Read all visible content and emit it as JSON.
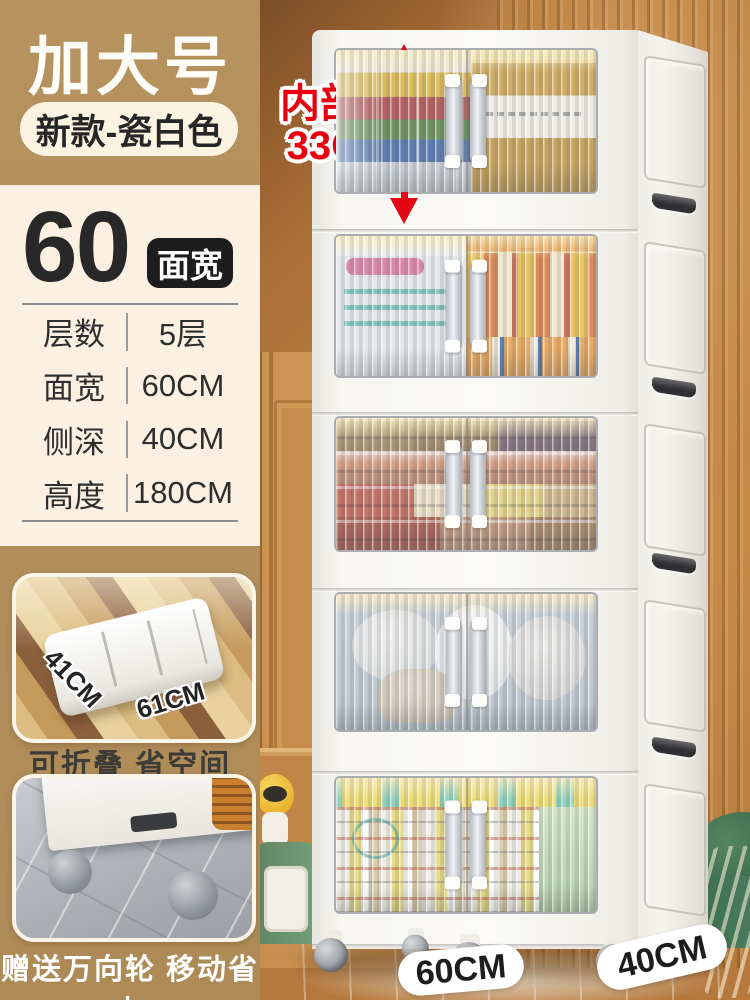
{
  "sidebar": {
    "title": "加大号",
    "variant_pill": "新款-瓷白色",
    "size": {
      "number": "60",
      "badge": "面宽"
    },
    "specs": [
      {
        "label": "层数",
        "value": "5层"
      },
      {
        "label": "面宽",
        "value": "60CM"
      },
      {
        "label": "侧深",
        "value": "40CM"
      },
      {
        "label": "高度",
        "value": "180CM"
      }
    ],
    "fold_photo": {
      "dim_left": "41CM",
      "dim_right": "61CM",
      "caption": "可折叠 省空间"
    },
    "wheel_photo": {
      "caption": "赠送万向轮 移动省力"
    }
  },
  "product": {
    "tier_count": 5,
    "annotations": {
      "inner_height_line1": "内部高",
      "inner_height_line2": "33CM",
      "width_floor_label": "60CM",
      "depth_floor_label": "40CM"
    }
  },
  "colors": {
    "sidebar_tan": "#b3905f",
    "panel_cream": "#fbf0e1",
    "badge_black": "#1d1d1d",
    "annotation_red": "#e8000e",
    "wall_brown": "#b5793e",
    "cabinet_white": "#f7f6f2",
    "pill_bg": "#fcf3e2"
  }
}
